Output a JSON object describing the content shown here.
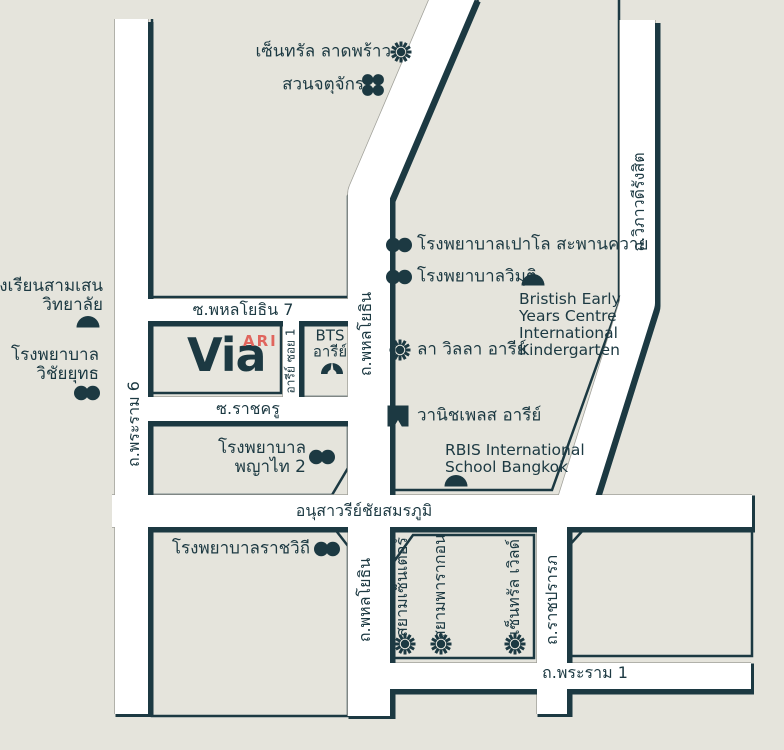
{
  "colors": {
    "background": "#e5e4dc",
    "ink": "#1c3942",
    "road_fill": "#ffffff",
    "road_edge": "#a0a099",
    "accent_red": "#e0655d"
  },
  "project": {
    "name": "Via",
    "sub": "ARI"
  },
  "roads": {
    "rama6": "ถ.พระราม 6",
    "phahonyothin_upper": "ถ.พหลโยธิน",
    "phahonyothin_lower": "ถ.พหลโยธิน",
    "viphavadi": "ถ.วิภาวดีรังสิต",
    "soi_phahonyothin7": "ซ.พหลโยธิน 7",
    "soi_rachakru": "ซ.ราชครู",
    "ari_soi1": "อารีย์ ซอย 1",
    "victory_monument": "อนุสาวรีย์ชัยสมรภูมิ",
    "ratchaprarop": "ถ.ราชปรารภ",
    "rama1": "ถ.พระราม 1"
  },
  "landmarks": {
    "central_ladprao": {
      "label": "เซ็นทรัล ลาดพร้าว",
      "icon": "sun"
    },
    "chatuchak_park": {
      "label": "สวนจตุจักร",
      "icon": "flower"
    },
    "paolo_hospital": {
      "label": "โรงพยาบาลเปาโล สะพานควาย",
      "icon": "hospital"
    },
    "vimut_hospital": {
      "label": "โรงพยาบาลวิมุติ",
      "icon": "hospital"
    },
    "bristish_kindergarten": {
      "lines": [
        "Bristish Early",
        "Years Centre",
        "International",
        "Kindergarten"
      ],
      "icon": "dome"
    },
    "samsen_school": {
      "lines": [
        "โรงเรียนสามเสน",
        "วิทยาลัย"
      ],
      "icon": "dome"
    },
    "vichaiyut_hospital": {
      "lines": [
        "โรงพยาบาล",
        "วิชัยยุทธ"
      ],
      "icon": "hospital"
    },
    "la_villa_ari": {
      "label": "ลา วิลลา อารีย์",
      "icon": "sun"
    },
    "bts_ari": {
      "lines": [
        "BTS",
        "อารีย์"
      ],
      "icon": "bts-arch"
    },
    "wanich_place_ari": {
      "label": "วานิชเพลส อารีย์",
      "icon": "flag"
    },
    "phyathai2_hospital": {
      "lines": [
        "โรงพยาบาล",
        "พญาไท 2"
      ],
      "icon": "hospital"
    },
    "rbis_school": {
      "lines": [
        "RBIS International",
        "School Bangkok"
      ],
      "icon": "dome"
    },
    "rajavithi_hospital": {
      "label": "โรงพยาบาลราชวิถี",
      "icon": "hospital"
    },
    "siam_center": {
      "label": "สยามเซ็นเตอร์",
      "icon": "sun"
    },
    "siam_paragon": {
      "label": "สยามพารากอน",
      "icon": "sun"
    },
    "central_world": {
      "label": "เซ็นทรัล เวิลด์",
      "icon": "sun"
    }
  }
}
